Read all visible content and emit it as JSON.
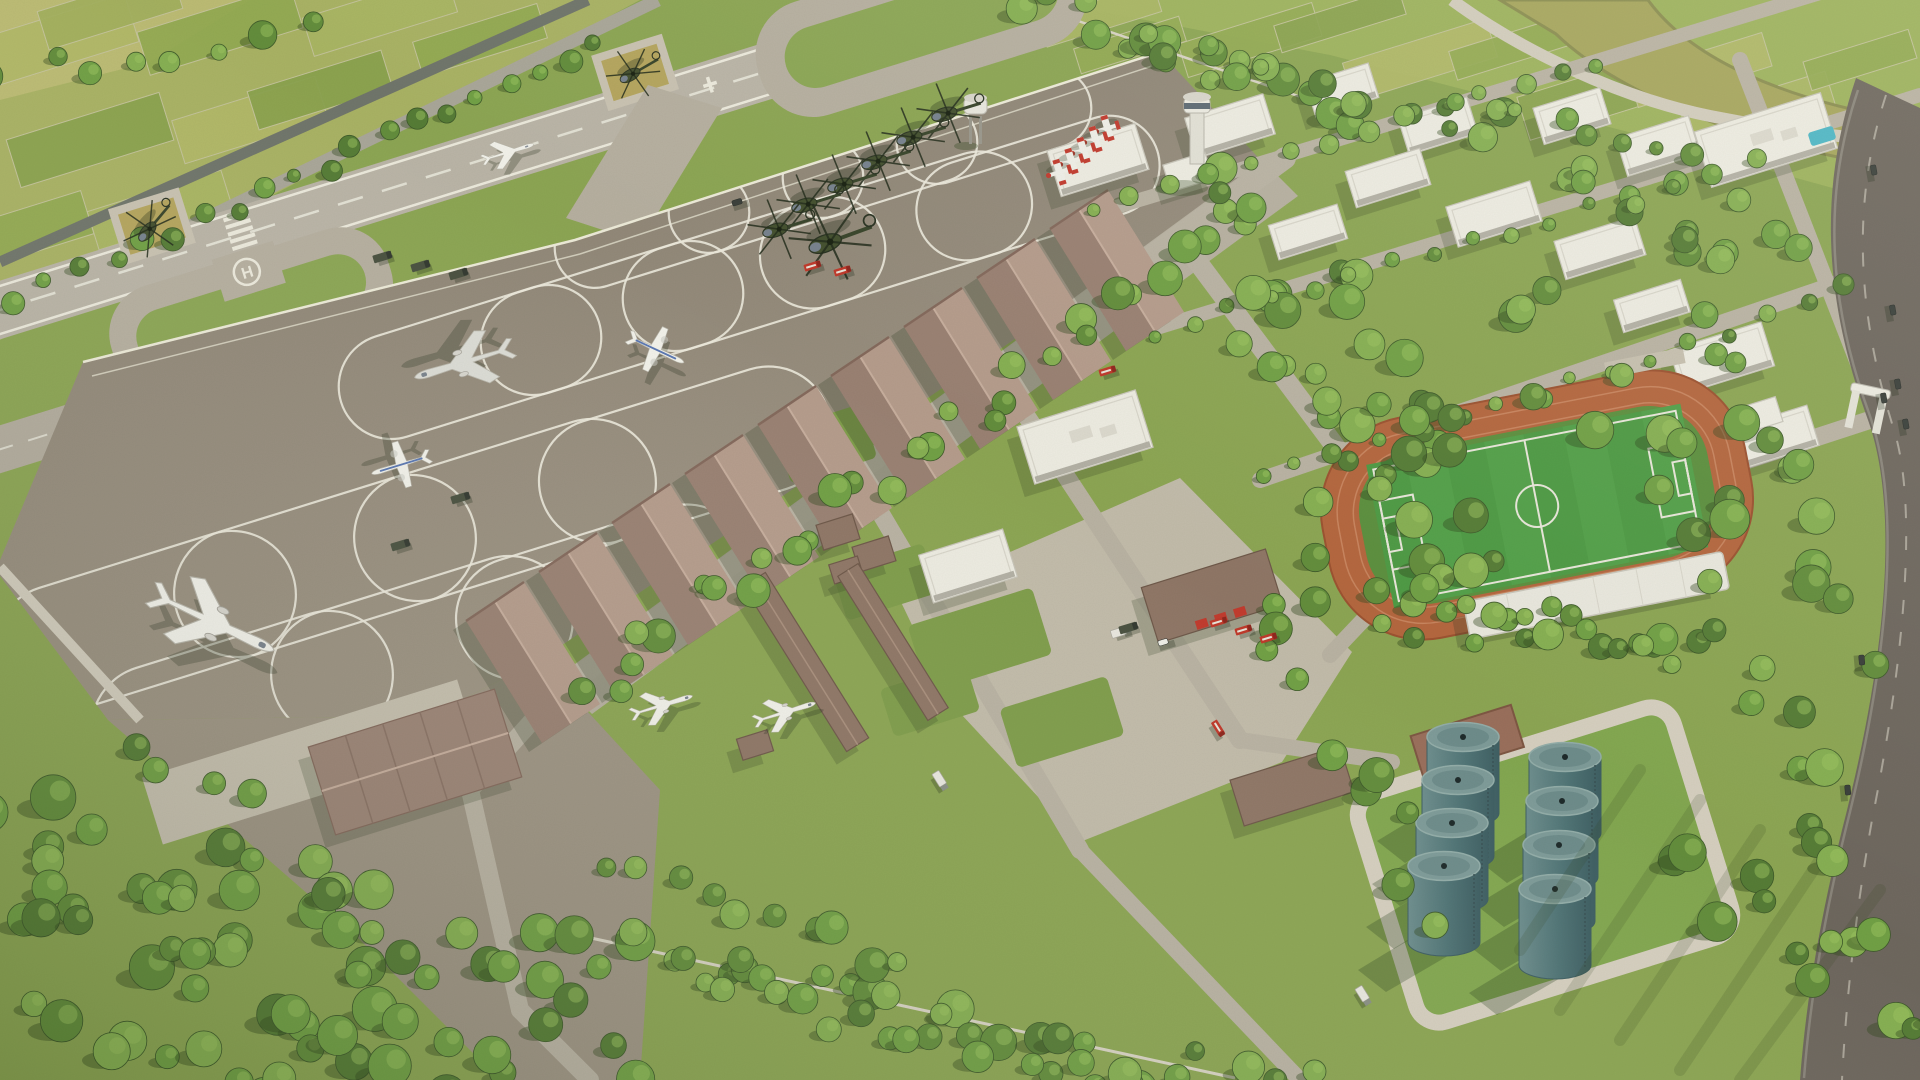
{
  "meta": {
    "description": "Aerial 3D architectural rendering of a military airbase masterplan: runway with turnaround loops, helicopter apron, hangar row, white campus buildings, control tower, sports field with running track, fuel tank farm, tree belts and surrounding farmland"
  },
  "labels": {
    "helipad_marking": "H"
  },
  "palette": {
    "grass_base": "#8CA553",
    "grass_light": "#9DB25F",
    "grass_campus": "#7F9D4B",
    "field_yellow": "#BCBB74",
    "runway": "#BAB4A7",
    "pavement": "#B6AFA0",
    "pavement_light": "#C6BFAF",
    "apron_dark": "#8A8172",
    "apron_light": "#9E9484",
    "concrete": "#D3CDBE",
    "road_dark": "#70756B",
    "road_mid": "#A9A699",
    "asphalt": "#6E675E",
    "marking_white": "#ECE9DD",
    "hangar_light": "#B59C8C",
    "hangar_dark": "#9A8173",
    "shed_brown": "#8F7666",
    "building_white": "#EDEBE2",
    "building_side": "#B3B0A5",
    "track_orange": "#B4663E",
    "pitch_green": "#4E9A44",
    "tank_teal": "#5F8183",
    "tank_top": "#7E9B99",
    "river_olive": "#A6A55C",
    "pool_blue": "#4DB6C6",
    "fire_red": "#C23B2E",
    "seats_blue": "#4A72B4",
    "helipad_khaki": "#B5A55E",
    "tree_shadow": "#33491F"
  },
  "objects": {
    "runway": 1,
    "taxiway_loops": 2,
    "helipads": 3,
    "hangars": 10,
    "fuel_tanks": 8,
    "helicopters": 9,
    "trainer_aircraft": 5,
    "airliners_and_transports": 6,
    "fighter_on_runway": 1,
    "sports_field": 1,
    "control_tower": 1,
    "water_tower": 1,
    "fire_trucks": 7,
    "entrance_gates": 2
  },
  "scene": {
    "angle": -17.3,
    "tree_palette": [
      "#567C36",
      "#638D3C",
      "#71A045",
      "#86AF52"
    ],
    "field_palette": [
      "#B2B868",
      "#93AA52",
      "#AAB663",
      "#8AA24E",
      "#A3B05E"
    ],
    "patches_tl": [
      [
        60,
        40,
        150,
        50,
        0
      ],
      [
        220,
        30,
        160,
        45,
        1
      ],
      [
        380,
        15,
        150,
        40,
        2
      ],
      [
        90,
        140,
        160,
        50,
        3
      ],
      [
        250,
        120,
        150,
        45,
        0
      ],
      [
        30,
        230,
        120,
        45,
        1
      ],
      [
        160,
        210,
        140,
        40,
        2
      ],
      [
        320,
        90,
        140,
        40,
        3
      ],
      [
        480,
        40,
        130,
        36,
        1
      ],
      [
        110,
        10,
        140,
        40,
        4
      ]
    ],
    "patches_tr": [
      [
        1100,
        15,
        120,
        30,
        2
      ],
      [
        1250,
        40,
        140,
        35,
        1
      ],
      [
        1420,
        60,
        150,
        40,
        0
      ],
      [
        1600,
        95,
        160,
        45,
        3
      ],
      [
        1760,
        115,
        150,
        45,
        2
      ],
      [
        1340,
        20,
        130,
        28,
        3
      ],
      [
        1520,
        45,
        140,
        30,
        1
      ],
      [
        1700,
        70,
        140,
        35,
        0
      ],
      [
        1860,
        60,
        110,
        30,
        1
      ],
      [
        1130,
        45,
        110,
        26,
        1
      ]
    ],
    "belts": [
      [
        20,
        300,
        600,
        40,
        20,
        9,
        8,
        0
      ],
      [
        0,
        70,
        300,
        30,
        8,
        11,
        16,
        1
      ],
      [
        1252,
        212,
        585,
        688,
        30,
        13,
        20,
        1
      ],
      [
        1215,
        168,
        1242,
        198,
        3,
        12,
        10,
        2
      ],
      [
        0,
        800,
        500,
        1055,
        22,
        17,
        36,
        1
      ],
      [
        0,
        905,
        420,
        1080,
        18,
        17,
        34,
        0
      ],
      [
        0,
        1015,
        300,
        1080,
        10,
        16,
        28,
        1
      ],
      [
        150,
        775,
        625,
        1072,
        20,
        15,
        30,
        2
      ],
      [
        540,
        930,
        1150,
        1080,
        26,
        15,
        26,
        1
      ],
      [
        700,
        1000,
        1310,
        1080,
        18,
        13,
        20,
        2
      ],
      [
        615,
        870,
        905,
        962,
        10,
        13,
        14,
        1
      ],
      [
        1040,
        8,
        1345,
        108,
        16,
        13,
        22,
        1
      ],
      [
        1150,
        35,
        1500,
        132,
        12,
        11,
        20,
        2
      ],
      [
        1265,
        282,
        1425,
        560,
        12,
        14,
        30,
        1
      ],
      [
        1322,
        268,
        1492,
        560,
        12,
        14,
        32,
        2
      ],
      [
        1255,
        600,
        1420,
        900,
        10,
        13,
        26,
        1
      ],
      [
        1390,
        620,
        1700,
        655,
        12,
        12,
        16,
        2
      ],
      [
        1380,
        585,
        1680,
        650,
        12,
        11,
        16,
        1
      ],
      [
        1685,
        185,
        1852,
        640,
        16,
        14,
        26,
        1
      ],
      [
        1705,
        525,
        1855,
        950,
        14,
        14,
        28,
        2
      ],
      [
        1650,
        825,
        1905,
        1045,
        12,
        15,
        44,
        3
      ],
      [
        1088,
        205,
        1600,
        63,
        14,
        8,
        6,
        2
      ],
      [
        1150,
        332,
        1752,
        162,
        16,
        8,
        6,
        1
      ],
      [
        1262,
        482,
        1850,
        292,
        16,
        8,
        8,
        2
      ],
      [
        1452,
        95,
        1700,
        160,
        8,
        9,
        10,
        1
      ],
      [
        1330,
        395,
        1316,
        600,
        5,
        12,
        10,
        1
      ],
      [
        1240,
        320,
        1480,
        470,
        8,
        15,
        40,
        2
      ],
      [
        1500,
        300,
        1700,
        480,
        10,
        15,
        40,
        1
      ],
      [
        1550,
        150,
        1800,
        260,
        10,
        12,
        30,
        2
      ]
    ],
    "ovals": [
      [
        652,
        230,
        200,
        80
      ],
      [
        766,
        195,
        200,
        80
      ],
      [
        880,
        160,
        200,
        80
      ],
      [
        994,
        126,
        200,
        80
      ],
      [
        470,
        362,
        270,
        105
      ],
      [
        612,
        318,
        270,
        105
      ],
      [
        754,
        274,
        270,
        105
      ],
      [
        896,
        230,
        280,
        105
      ],
      [
        1038,
        188,
        250,
        100
      ],
      [
        145,
        622,
        310,
        128
      ],
      [
        325,
        566,
        310,
        128
      ],
      [
        505,
        510,
        310,
        128
      ],
      [
        685,
        455,
        300,
        125
      ],
      [
        242,
        702,
        310,
        128
      ],
      [
        422,
        647,
        310,
        128
      ],
      [
        602,
        592,
        300,
        122
      ]
    ],
    "curves": [
      "M83,362 Q300,330 575,242",
      "M120,480 Q260,430 420,392",
      "M60,580 Q200,520 360,470",
      "M86,432 Q140,408 214,395"
    ],
    "hangars": {
      "start": [
        1108,
        190
      ],
      "step": [
        -73,
        49
      ],
      "across": [
        -58,
        39
      ],
      "along": [
        76,
        122
      ],
      "n": 9
    },
    "tanks": [
      [
        1463,
        737
      ],
      [
        1458,
        780
      ],
      [
        1452,
        823
      ],
      [
        1444,
        866
      ],
      [
        1565,
        757
      ],
      [
        1562,
        801
      ],
      [
        1559,
        845
      ],
      [
        1555,
        889
      ]
    ],
    "helicopters": [
      [
        952,
        112,
        1,
        163
      ],
      [
        917,
        136,
        1,
        163
      ],
      [
        882,
        160,
        1,
        163
      ],
      [
        848,
        183,
        1,
        163
      ],
      [
        812,
        203,
        1,
        163
      ],
      [
        783,
        228,
        1,
        163
      ],
      [
        835,
        240,
        1.3,
        160
      ],
      [
        152,
        226,
        0.9,
        130
      ],
      [
        636,
        72,
        0.85,
        150
      ]
    ],
    "trainers": [
      [
        1108,
        128
      ],
      [
        1096,
        139
      ],
      [
        1084,
        150
      ],
      [
        1072,
        161
      ],
      [
        1060,
        172
      ]
    ],
    "aircraft": [
      [
        "jet",
        215,
        623,
        25,
        1.05,
        "w"
      ],
      [
        "jet",
        462,
        363,
        163,
        0.8,
        "g"
      ],
      [
        "prop",
        400,
        465,
        163,
        0.62,
        "w"
      ],
      [
        "prop",
        657,
        350,
        25,
        0.62,
        "w"
      ],
      [
        "jet",
        663,
        705,
        -17,
        0.5,
        "w"
      ],
      [
        "jet",
        786,
        712,
        -17,
        0.5,
        "w"
      ],
      [
        "fighter",
        509,
        152,
        -17.3,
        0.42,
        "w"
      ]
    ],
    "vehicles": [
      [
        "truck",
        382,
        257,
        -17
      ],
      [
        "truck",
        420,
        266,
        -17
      ],
      [
        "truck",
        458,
        274,
        -17
      ],
      [
        "truck",
        460,
        498,
        -17
      ],
      [
        "truck",
        400,
        545,
        -17
      ],
      [
        "car",
        737,
        202,
        -17,
        "d"
      ],
      [
        "fire",
        812,
        266,
        -17
      ],
      [
        "fire",
        842,
        271,
        -17
      ],
      [
        "fire",
        1107,
        371,
        -17
      ],
      [
        "fire",
        1218,
        622,
        -17
      ],
      [
        "fire",
        1243,
        630,
        -17
      ],
      [
        "fire",
        1268,
        638,
        -17
      ],
      [
        "fire",
        1218,
        728,
        58
      ],
      [
        "box",
        940,
        780,
        58
      ],
      [
        "box",
        1120,
        632,
        -17
      ],
      [
        "car",
        1163,
        642,
        -17,
        "w"
      ],
      [
        "box",
        1363,
        995,
        58
      ],
      [
        "car",
        1874,
        170,
        80,
        "d"
      ],
      [
        "car",
        1893,
        310,
        80,
        "d"
      ],
      [
        "car",
        1898,
        384,
        80,
        "d"
      ],
      [
        "car",
        1884,
        398,
        80,
        "d"
      ],
      [
        "car",
        1906,
        424,
        80,
        "d"
      ],
      [
        "car",
        1862,
        660,
        85,
        "d"
      ],
      [
        "car",
        1848,
        790,
        85,
        "d"
      ],
      [
        "truck",
        1128,
        628,
        -17
      ]
    ],
    "buildings": [
      [
        1098,
        160,
        92,
        48,
        "w"
      ],
      [
        1230,
        126,
        82,
        42,
        "w"
      ],
      [
        1342,
        90,
        66,
        36,
        "w"
      ],
      [
        1438,
        126,
        72,
        38,
        "w"
      ],
      [
        1572,
        116,
        70,
        38,
        "w"
      ],
      [
        1658,
        146,
        76,
        40,
        "w"
      ],
      [
        1766,
        140,
        132,
        58,
        "w"
      ],
      [
        1388,
        178,
        78,
        38,
        "w"
      ],
      [
        1494,
        214,
        88,
        42,
        "w"
      ],
      [
        1600,
        248,
        84,
        40,
        "w"
      ],
      [
        1308,
        232,
        72,
        36,
        "w"
      ],
      [
        1085,
        437,
        124,
        60,
        "w"
      ],
      [
        968,
        566,
        88,
        50,
        "w"
      ],
      [
        1722,
        358,
        96,
        46,
        "w"
      ],
      [
        1772,
        438,
        86,
        42,
        "w"
      ],
      [
        1652,
        306,
        70,
        34,
        "w"
      ],
      [
        1188,
        172,
        44,
        28,
        "w"
      ],
      [
        1212,
        596,
        130,
        58,
        "f"
      ],
      [
        1292,
        786,
        115,
        48,
        "b"
      ],
      [
        415,
        762,
        195,
        92,
        "h"
      ],
      [
        838,
        532,
        38,
        26,
        "b"
      ],
      [
        874,
        554,
        38,
        26,
        "b"
      ],
      [
        846,
        570,
        30,
        20,
        "b"
      ],
      [
        755,
        745,
        32,
        22,
        "b"
      ],
      [
        1760,
        415,
        40,
        26,
        "g"
      ],
      [
        806,
        662,
        195,
        26,
        "b",
        58
      ],
      [
        893,
        642,
        170,
        24,
        "b",
        58
      ]
    ],
    "roads": [
      [
        1285,
        158,
        560,
        690,
        22
      ],
      [
        560,
        690,
        470,
        790,
        18
      ],
      [
        470,
        790,
        520,
        1010,
        18
      ],
      [
        520,
        1010,
        590,
        1080,
        18
      ],
      [
        1185,
        245,
        1420,
        560,
        20
      ],
      [
        1008,
        388,
        1240,
        740,
        18
      ],
      [
        868,
        492,
        1080,
        850,
        18
      ],
      [
        1080,
        850,
        1300,
        1080,
        16
      ],
      [
        1240,
        740,
        1392,
        762,
        16
      ],
      [
        1090,
        215,
        1830,
        -10,
        14
      ],
      [
        1150,
        330,
        1920,
        95,
        14
      ],
      [
        1260,
        480,
        1920,
        255,
        16
      ],
      [
        1740,
        60,
        1880,
        420,
        16
      ],
      [
        1885,
        415,
        1640,
        495,
        18
      ],
      [
        1420,
        560,
        1330,
        655,
        16
      ]
    ],
    "lawns": [
      [
        980,
        640,
        130,
        70
      ],
      [
        885,
        582,
        95,
        52
      ],
      [
        1062,
        722,
        112,
        62
      ],
      [
        930,
        700,
        90,
        50
      ],
      [
        826,
        444,
        90,
        56
      ]
    ],
    "stripes": [
      "M1700,800 L1560,1010",
      "M1760,830 L1620,1040",
      "M1820,860 L1680,1070",
      "M1880,890 L1740,1080",
      "M1640,770 L1520,950"
    ]
  }
}
